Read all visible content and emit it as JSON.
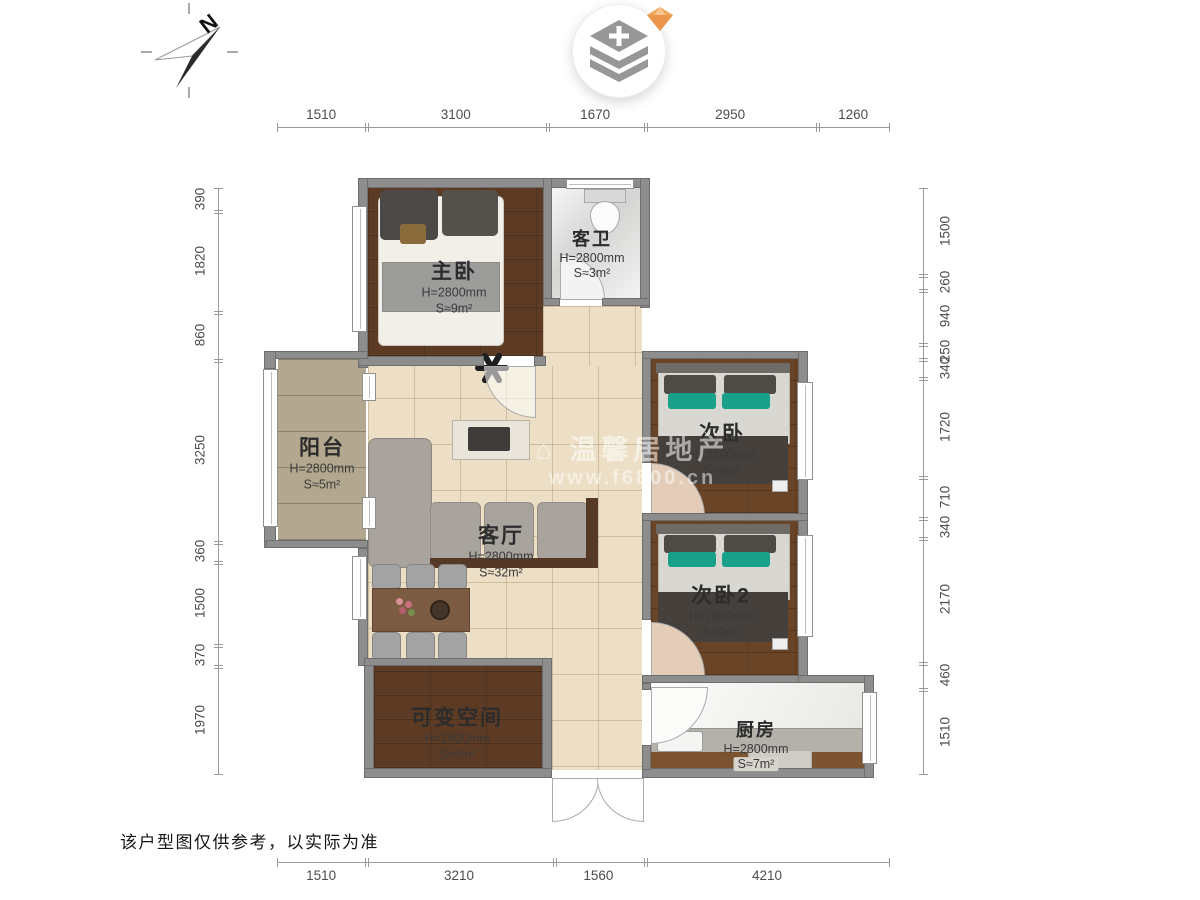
{
  "page": {
    "disclaimer": "该户型图仅供参考，以实际为准",
    "compass_label": "N"
  },
  "watermark": {
    "line1": "⌂ 温馨居地产",
    "line2": "www.f6800.cn"
  },
  "dims": {
    "top": [
      "1510",
      "3100",
      "1670",
      "2950",
      "1260"
    ],
    "bottom": [
      "1510",
      "3210",
      "1560",
      "4210"
    ],
    "left": [
      "390",
      "1820",
      "860",
      "3250",
      "360",
      "1500",
      "370",
      "1970"
    ],
    "right": [
      "1500",
      "260",
      "940",
      "250",
      "340",
      "1720",
      "710",
      "340",
      "2170",
      "460",
      "1510"
    ]
  },
  "rooms": {
    "master": {
      "name": "主卧",
      "height": "H=2800mm",
      "area": "S≈9m²"
    },
    "bath": {
      "name": "客卫",
      "height": "H=2800mm",
      "area": "S≈3m²"
    },
    "balcony": {
      "name": "阳台",
      "height": "H=2800mm",
      "area": "S≈5m²"
    },
    "living": {
      "name": "客厅",
      "height": "H=2800mm",
      "area": "S≈32m²"
    },
    "bed2": {
      "name": "次卧",
      "height": "H=2800mm",
      "area": "S≈8m²"
    },
    "bed3": {
      "name": "次卧2",
      "height": "H=2800mm",
      "area": "S≈9m²"
    },
    "flex": {
      "name": "可变空间",
      "height": "H=2800mm",
      "area": "S≈6m²"
    },
    "kitchen": {
      "name": "厨房",
      "height": "H=2800mm",
      "area": "S≈7m²"
    }
  },
  "colors": {
    "accent_orange": "#f0a259",
    "wall_gray": "#8d8d8d",
    "wood_brown": "#5d3a23",
    "tile_beige": "#ecdfc5",
    "teal_pillow": "#18a188"
  }
}
